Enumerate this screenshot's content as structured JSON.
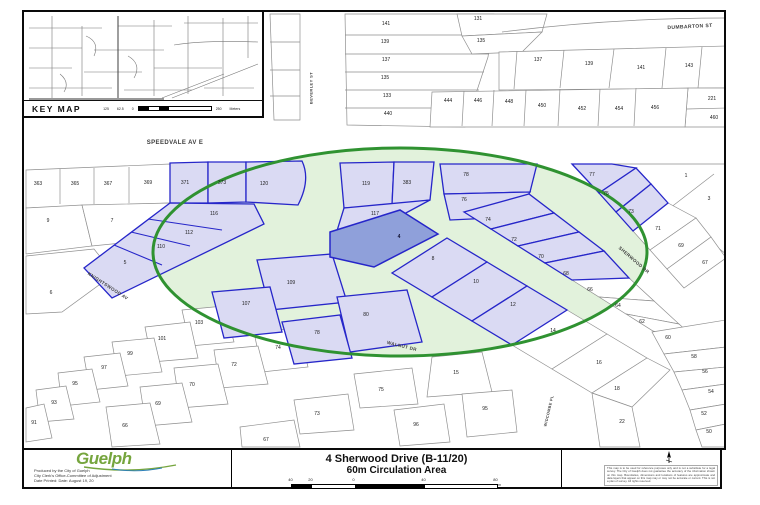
{
  "map": {
    "key_map": {
      "title": "KEY MAP",
      "scale_labels": [
        "125",
        "62.5",
        "0",
        "250"
      ],
      "scale_units": "Meters"
    },
    "circle": {
      "meaning": "60m Circulation Area",
      "color": "#2f9231"
    },
    "streets": [
      {
        "n": "DUMBARTON ST",
        "x": 690,
        "y": 27,
        "r": -3,
        "s": 5
      },
      {
        "n": "BEVERLEY ST",
        "x": 311,
        "y": 88,
        "r": -90,
        "s": 4
      },
      {
        "n": "SPEEDVALE AV E",
        "x": 175,
        "y": 143,
        "r": 0,
        "s": 6
      },
      {
        "n": "KNIGHTSWOOD AV",
        "x": 108,
        "y": 286,
        "r": 33,
        "s": 4.5
      },
      {
        "n": "SHERWOOD DR",
        "x": 634,
        "y": 260,
        "r": 41,
        "s": 4.5
      },
      {
        "n": "WALNUT DR",
        "x": 402,
        "y": 346,
        "r": 14,
        "s": 4.5
      },
      {
        "n": "WIDCOMBE PL",
        "x": 549,
        "y": 411,
        "r": -77,
        "s": 3.8
      }
    ],
    "lots": [
      {
        "n": "141",
        "x": 386,
        "y": 24,
        "t": "w"
      },
      {
        "n": "139",
        "x": 385,
        "y": 42,
        "t": "w"
      },
      {
        "n": "137",
        "x": 386,
        "y": 60,
        "t": "w"
      },
      {
        "n": "135",
        "x": 385,
        "y": 78,
        "t": "w"
      },
      {
        "n": "133",
        "x": 387,
        "y": 96,
        "t": "w"
      },
      {
        "n": "440",
        "x": 388,
        "y": 114,
        "t": "w"
      },
      {
        "n": "131",
        "x": 478,
        "y": 19,
        "t": "w"
      },
      {
        "n": "135",
        "x": 481,
        "y": 41,
        "t": "w"
      },
      {
        "n": "137",
        "x": 538,
        "y": 60,
        "t": "w"
      },
      {
        "n": "139",
        "x": 589,
        "y": 64,
        "t": "w"
      },
      {
        "n": "141",
        "x": 641,
        "y": 68,
        "t": "w"
      },
      {
        "n": "143",
        "x": 689,
        "y": 66,
        "t": "w"
      },
      {
        "n": "444",
        "x": 448,
        "y": 101,
        "t": "w"
      },
      {
        "n": "446",
        "x": 478,
        "y": 101,
        "t": "w"
      },
      {
        "n": "448",
        "x": 509,
        "y": 102,
        "t": "w"
      },
      {
        "n": "450",
        "x": 542,
        "y": 106,
        "t": "w"
      },
      {
        "n": "452",
        "x": 582,
        "y": 109,
        "t": "w"
      },
      {
        "n": "454",
        "x": 619,
        "y": 109,
        "t": "w"
      },
      {
        "n": "456",
        "x": 655,
        "y": 108,
        "t": "w"
      },
      {
        "n": "221",
        "x": 712,
        "y": 99,
        "t": "w"
      },
      {
        "n": "460",
        "x": 714,
        "y": 118,
        "t": "w"
      },
      {
        "n": "363",
        "x": 38,
        "y": 184,
        "t": "w"
      },
      {
        "n": "365",
        "x": 75,
        "y": 184,
        "t": "w"
      },
      {
        "n": "367",
        "x": 108,
        "y": 184,
        "t": "w"
      },
      {
        "n": "369",
        "x": 148,
        "y": 183,
        "t": "w"
      },
      {
        "n": "371",
        "x": 185,
        "y": 183,
        "t": "b"
      },
      {
        "n": "373",
        "x": 222,
        "y": 183,
        "t": "b"
      },
      {
        "n": "120",
        "x": 264,
        "y": 184,
        "t": "b"
      },
      {
        "n": "9",
        "x": 48,
        "y": 221,
        "t": "w"
      },
      {
        "n": "7",
        "x": 112,
        "y": 221,
        "t": "w"
      },
      {
        "n": "6",
        "x": 51,
        "y": 293,
        "t": "w"
      },
      {
        "n": "116",
        "x": 214,
        "y": 214,
        "t": "b"
      },
      {
        "n": "112",
        "x": 189,
        "y": 233,
        "t": "b"
      },
      {
        "n": "110",
        "x": 161,
        "y": 247,
        "t": "b"
      },
      {
        "n": "5",
        "x": 125,
        "y": 263,
        "t": "b"
      },
      {
        "n": "119",
        "x": 366,
        "y": 184,
        "t": "b"
      },
      {
        "n": "383",
        "x": 407,
        "y": 183,
        "t": "b"
      },
      {
        "n": "117",
        "x": 375,
        "y": 214,
        "t": "b"
      },
      {
        "n": "4",
        "x": 399,
        "y": 237,
        "t": "s"
      },
      {
        "n": "78",
        "x": 466,
        "y": 175,
        "t": "b"
      },
      {
        "n": "76",
        "x": 464,
        "y": 200,
        "t": "b"
      },
      {
        "n": "74",
        "x": 488,
        "y": 220,
        "t": "b"
      },
      {
        "n": "72",
        "x": 514,
        "y": 240,
        "t": "b"
      },
      {
        "n": "70",
        "x": 541,
        "y": 257,
        "t": "b"
      },
      {
        "n": "68",
        "x": 566,
        "y": 274,
        "t": "b"
      },
      {
        "n": "66",
        "x": 590,
        "y": 290,
        "t": "w"
      },
      {
        "n": "64",
        "x": 618,
        "y": 306,
        "t": "w"
      },
      {
        "n": "62",
        "x": 642,
        "y": 322,
        "t": "w"
      },
      {
        "n": "77",
        "x": 592,
        "y": 175,
        "t": "b"
      },
      {
        "n": "75",
        "x": 606,
        "y": 194,
        "t": "b"
      },
      {
        "n": "73",
        "x": 631,
        "y": 212,
        "t": "b"
      },
      {
        "n": "71",
        "x": 658,
        "y": 229,
        "t": "w"
      },
      {
        "n": "69",
        "x": 681,
        "y": 246,
        "t": "w"
      },
      {
        "n": "67",
        "x": 705,
        "y": 263,
        "t": "w"
      },
      {
        "n": "1",
        "x": 686,
        "y": 176,
        "t": "w"
      },
      {
        "n": "3",
        "x": 709,
        "y": 199,
        "t": "w"
      },
      {
        "n": "60",
        "x": 668,
        "y": 338,
        "t": "w"
      },
      {
        "n": "58",
        "x": 694,
        "y": 357,
        "t": "w"
      },
      {
        "n": "56",
        "x": 705,
        "y": 372,
        "t": "w"
      },
      {
        "n": "54",
        "x": 711,
        "y": 392,
        "t": "w"
      },
      {
        "n": "52",
        "x": 704,
        "y": 414,
        "t": "w"
      },
      {
        "n": "50",
        "x": 709,
        "y": 432,
        "t": "w"
      },
      {
        "n": "8",
        "x": 433,
        "y": 259,
        "t": "b"
      },
      {
        "n": "10",
        "x": 476,
        "y": 282,
        "t": "b"
      },
      {
        "n": "12",
        "x": 513,
        "y": 305,
        "t": "b"
      },
      {
        "n": "14",
        "x": 553,
        "y": 331,
        "t": "w"
      },
      {
        "n": "16",
        "x": 599,
        "y": 363,
        "t": "w"
      },
      {
        "n": "18",
        "x": 617,
        "y": 389,
        "t": "w"
      },
      {
        "n": "22",
        "x": 622,
        "y": 422,
        "t": "w"
      },
      {
        "n": "15",
        "x": 456,
        "y": 373,
        "t": "w"
      },
      {
        "n": "95",
        "x": 485,
        "y": 409,
        "t": "w"
      },
      {
        "n": "109",
        "x": 291,
        "y": 283,
        "t": "b"
      },
      {
        "n": "107",
        "x": 246,
        "y": 304,
        "t": "b"
      },
      {
        "n": "80",
        "x": 366,
        "y": 315,
        "t": "b"
      },
      {
        "n": "78",
        "x": 317,
        "y": 333,
        "t": "b"
      },
      {
        "n": "103",
        "x": 199,
        "y": 323,
        "t": "w"
      },
      {
        "n": "101",
        "x": 162,
        "y": 339,
        "t": "w"
      },
      {
        "n": "99",
        "x": 130,
        "y": 354,
        "t": "w"
      },
      {
        "n": "97",
        "x": 104,
        "y": 368,
        "t": "w"
      },
      {
        "n": "95",
        "x": 75,
        "y": 384,
        "t": "w"
      },
      {
        "n": "93",
        "x": 54,
        "y": 403,
        "t": "w"
      },
      {
        "n": "91",
        "x": 34,
        "y": 423,
        "t": "w"
      },
      {
        "n": "74",
        "x": 278,
        "y": 348,
        "t": "w"
      },
      {
        "n": "72",
        "x": 234,
        "y": 365,
        "t": "w"
      },
      {
        "n": "70",
        "x": 192,
        "y": 385,
        "t": "w"
      },
      {
        "n": "69",
        "x": 158,
        "y": 404,
        "t": "w"
      },
      {
        "n": "66",
        "x": 125,
        "y": 426,
        "t": "w"
      },
      {
        "n": "75",
        "x": 381,
        "y": 390,
        "t": "w"
      },
      {
        "n": "73",
        "x": 317,
        "y": 414,
        "t": "w"
      },
      {
        "n": "67",
        "x": 266,
        "y": 440,
        "t": "w"
      },
      {
        "n": "96",
        "x": 416,
        "y": 425,
        "t": "w"
      }
    ]
  },
  "title_block": {
    "logo_text": "Guelph",
    "credits": [
      "Produced by the City of Guelph",
      "City Clerk's Office-Committee of Adjustment",
      "Date Printed: Date: August 19, 20"
    ],
    "title_line1": "4 Sherwood Drive (B-11/20)",
    "title_line2": "60m Circulation Area",
    "scale": {
      "labels": [
        {
          "t": "40",
          "x": 0
        },
        {
          "t": "20",
          "x": 20
        },
        {
          "t": "0",
          "x": 63
        },
        {
          "t": "40",
          "x": 133
        },
        {
          "t": "80",
          "x": 205
        }
      ],
      "unit": "m"
    },
    "disclaimer": "This map is to be used for reference purposes only and is not a substitute for a legal survey. The City of Guelph does not guarantee the accuracy of the information shown on this map. Boundaries, dimensions and locations of features are approximate and data layers that appear on this map may or may not be accurate or current. This is not a plan of survey. All rights reserved."
  },
  "colors": {
    "circle_green": "#2f9231",
    "highlight_fill": "#dadaf3",
    "highlight_stroke": "#2626c9",
    "subject_fill": "#8fa0da",
    "logo_green": "#76a53e"
  }
}
